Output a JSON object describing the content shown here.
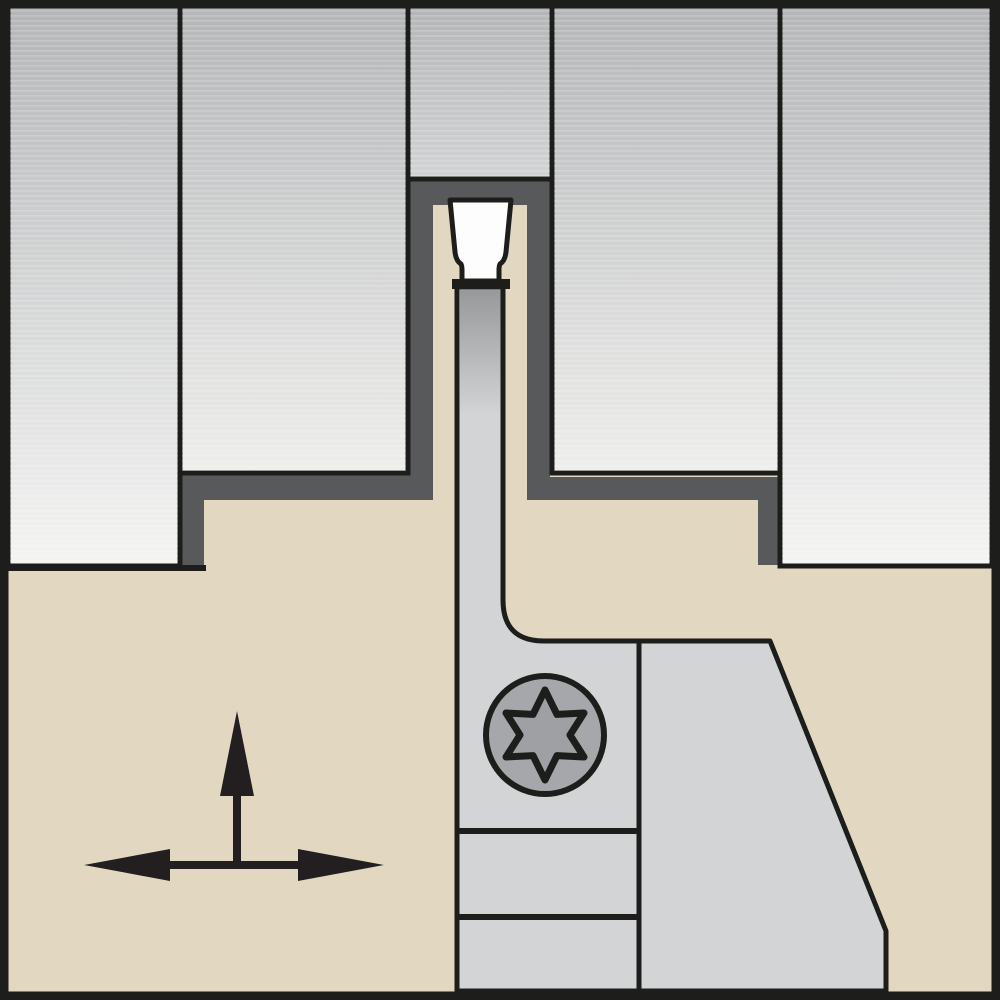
{
  "diagram": {
    "type": "technical-illustration",
    "subject": "Grooving / parting tool holder cross-section shown cutting a groove in a workpiece",
    "components": {
      "workpiece": "Workpiece material (gray gradient blocks, sectioned)",
      "groove_profile": "Machined groove profile surface (dark gray band)",
      "toolholder": "Tool holder body (tan)",
      "blade": "Parting blade / support (light gray)",
      "insert": "Cutting insert (white, trapezoidal with clamping neck)",
      "clamp_screw": "Torx clamp screw head",
      "feed_arrows": "Feed direction indicator: up arrow and left-right double arrow"
    }
  },
  "colors": {
    "outline": "#1d1d1b",
    "dark_gray": "#58595b",
    "tan": "#e2d8c2",
    "blade_gray": "#d3d4d6",
    "insert_white": "#fdfdfd",
    "screw_gray": "#a5a7aa",
    "socket_gray": "#9ea0a3",
    "arrow_black": "#231f20",
    "workpiece_top": "#b3b5b7",
    "workpiece_bottom_tall": "#f4f4f3",
    "workpiece_bottom_mid": "#eeeeec",
    "workpiece_bottom_stub": "#d2d3d5",
    "stripe_white": "#ffffff"
  }
}
